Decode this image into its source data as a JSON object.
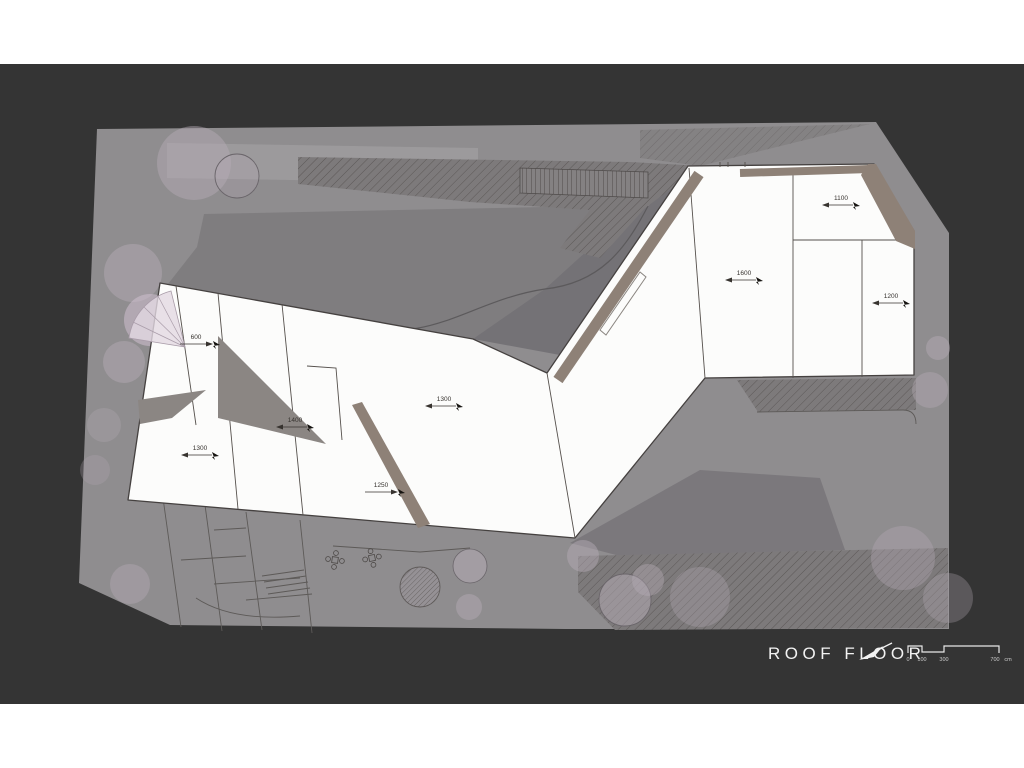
{
  "title": {
    "label": "ROOF FLOOR"
  },
  "scale_bar": {
    "ticks": [
      "0",
      "100",
      "300",
      "700"
    ],
    "unit": "cm"
  },
  "slope_labels": [
    {
      "text": "600"
    },
    {
      "text": "1300"
    },
    {
      "text": "1400"
    },
    {
      "text": "1300"
    },
    {
      "text": "1250"
    },
    {
      "text": "1600"
    },
    {
      "text": "1100"
    },
    {
      "text": "1200"
    }
  ],
  "colors": {
    "canvas_background": "#343434",
    "site_gray": "#8f8d8f",
    "roof_white": "#fcfcfb",
    "outline": "#454140",
    "taupe_band": "#8e8177",
    "shadow_gray": "#8b8683",
    "stair_fan": "#e2d8e2",
    "title_text": "#f2f2f2"
  }
}
